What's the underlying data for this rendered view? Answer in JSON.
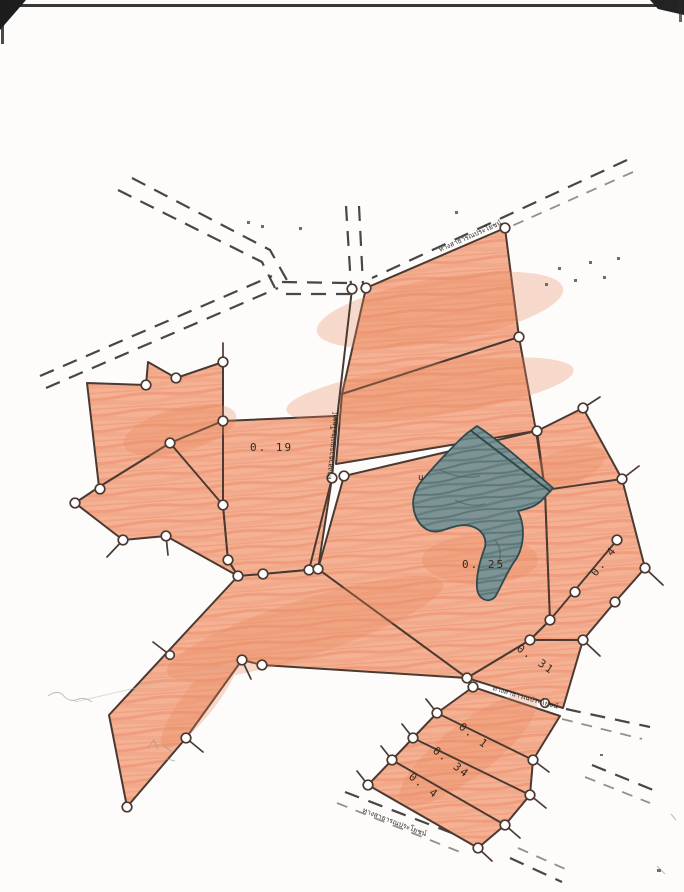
{
  "document": {
    "type": "scanned cadastral survey sketch map",
    "language": "Thai"
  },
  "colors": {
    "paper": "#ffffff",
    "parcel_base": "#f5b193",
    "parcel_hatch": "#e78f6b",
    "outline": "#4b3a31",
    "pond_base": "#7d9394",
    "pond_dark": "#4e686b",
    "road": "#2f2d2b",
    "label": "#33291f"
  },
  "parcel_labels": [
    {
      "text": "0. 19"
    },
    {
      "text": "0. 25"
    },
    {
      "text": "0. 31"
    },
    {
      "text": "0. 4"
    },
    {
      "text": "0. 1"
    },
    {
      "text": "0. 34"
    },
    {
      "text": "0. 4"
    }
  ],
  "road_labels": {
    "vertical": "ทางสาธารณประโยชน์",
    "top_right": "ทางสาธารณประโยชน์",
    "middle": "ทางสาธารณประโยชน์",
    "bottom": "ทางสาธารณประโยชน์"
  },
  "annotations": {
    "mark": "u"
  }
}
